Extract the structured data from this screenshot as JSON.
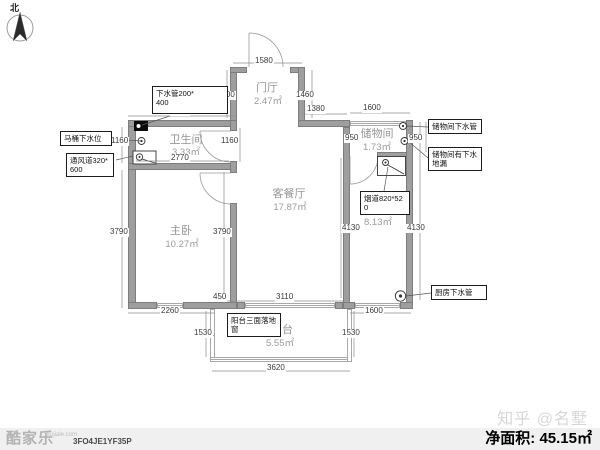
{
  "compass": {
    "north_label": "北"
  },
  "rooms": [
    {
      "name": "卫生间",
      "area": "3.33㎡"
    },
    {
      "name": "门厅",
      "area": "2.47㎡"
    },
    {
      "name": "客餐厅",
      "area": "17.87㎡"
    },
    {
      "name": "储物间",
      "area": "1.73㎡"
    },
    {
      "name": "主卧",
      "area": "10.27㎡"
    },
    {
      "name": "厨房",
      "area": "8.13㎡"
    },
    {
      "name": "阳台",
      "area": "5.55㎡"
    }
  ],
  "annotations": [
    {
      "text": "下水管200*\n400"
    },
    {
      "text": "马桶下水位"
    },
    {
      "text": "通风道320*\n600"
    },
    {
      "text": "储物间下水管"
    },
    {
      "text": "储物间有下水\n地漏"
    },
    {
      "text": "烟道820*52\n0"
    },
    {
      "text": "阳台三面落地\n窗"
    },
    {
      "text": "厨房下水管"
    }
  ],
  "dims": [
    "2860",
    "1580",
    "1380",
    "1600",
    "1400",
    "1460",
    "1160",
    "1160",
    "2770",
    "950",
    "950",
    "3790",
    "3790",
    "4130",
    "4130",
    "450",
    "3110",
    "2260",
    "1600",
    "1530",
    "1530",
    "3620"
  ],
  "footer": {
    "logo": "酷家乐",
    "logo_sub": "kujiale.com",
    "code": "3FO4JE1YF35P",
    "net_area": "净面积: 45.15㎡"
  },
  "watermark": "知乎 @名墅",
  "colors": {
    "wall": "#9e9e9e",
    "annotation_border": "#1c1c1c",
    "room_text": "#969696",
    "footer_bg": "#f0f0f0",
    "watermark_text": "#d7d7d7"
  }
}
